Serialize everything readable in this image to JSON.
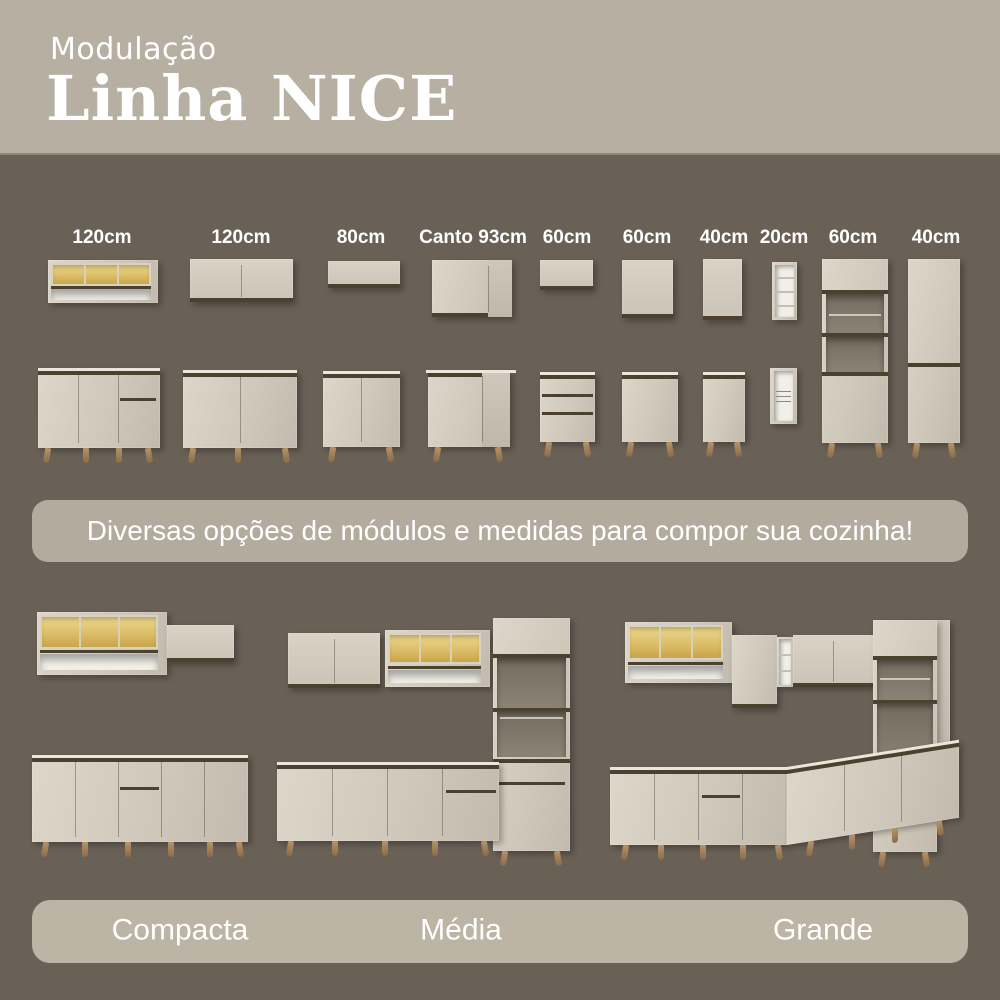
{
  "header": {
    "subtitle": "Modulação",
    "title": "Linha NICE"
  },
  "modules": {
    "labels": [
      "120cm",
      "120cm",
      "80cm",
      "Canto 93cm",
      "60cm",
      "60cm",
      "40cm",
      "20cm",
      "60cm",
      "40cm"
    ]
  },
  "banner": {
    "text": "Diversas opções de módulos e medidas para compor sua cozinha!"
  },
  "kitchens": [
    {
      "label": "Compacta"
    },
    {
      "label": "Média"
    },
    {
      "label": "Grande"
    }
  ],
  "colors": {
    "header_background": "#b7b0a2",
    "page_background": "#6a6156",
    "banner_background": "#b3ab9d",
    "footer_background": "#bcb4a5",
    "cabinet_cream": "#d6d0c2",
    "trim_brown": "#4c402e",
    "glass_amber": "#dcbd68",
    "open_shelf_white": "#f3f1ea",
    "leg_wood": "#a98a62",
    "text_white": "#ffffff"
  }
}
